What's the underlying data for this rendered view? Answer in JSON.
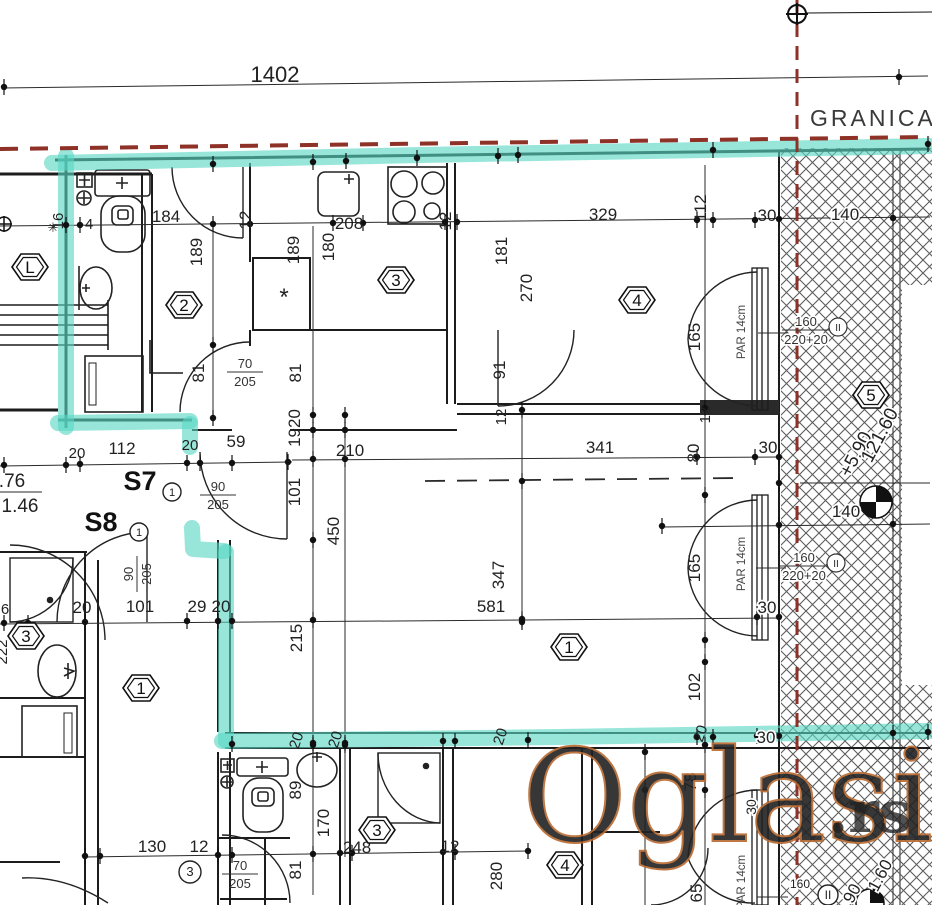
{
  "header": {
    "granica_label": "GRANICA",
    "top_dimension": "1402"
  },
  "stairs": {
    "s7": "S7",
    "s8": "S8"
  },
  "watermark": {
    "text": "Oglasi",
    "suffix": ".rs"
  },
  "colors": {
    "highlight": "#59d7c4",
    "boundary_red": "#8e3127",
    "wall": "#1c1c1c",
    "watermark_light": "#fcd9b0",
    "watermark_dark": "#d97f3e",
    "watermark_outline": "#b96a30",
    "watermark_suffix_gray": "#9b9b9b"
  },
  "par_window_label": "PAR 14cm",
  "dim_labels": [
    {
      "t": "16",
      "x": 63,
      "y": 221,
      "r": -90,
      "s": 15
    },
    {
      "t": "4",
      "x": 89,
      "y": 229,
      "s": 15
    },
    {
      "t": "184",
      "x": 166,
      "y": 222
    },
    {
      "t": "12",
      "x": 251,
      "y": 220,
      "r": -90
    },
    {
      "t": "208",
      "x": 349,
      "y": 229
    },
    {
      "t": "12",
      "x": 451,
      "y": 221,
      "r": -90
    },
    {
      "t": "329",
      "x": 603,
      "y": 220
    },
    {
      "t": "112",
      "x": 706,
      "y": 208,
      "r": -90
    },
    {
      "t": "30",
      "x": 767,
      "y": 221
    },
    {
      "t": "140",
      "x": 845,
      "y": 220,
      "h": 1
    },
    {
      "t": "189",
      "x": 202,
      "y": 252,
      "r": -90
    },
    {
      "t": "189",
      "x": 299,
      "y": 250,
      "r": -90
    },
    {
      "t": "180",
      "x": 334,
      "y": 247,
      "r": -90
    },
    {
      "t": "181",
      "x": 507,
      "y": 251,
      "r": -90
    },
    {
      "t": "270",
      "x": 532,
      "y": 288,
      "r": -90
    },
    {
      "t": "91",
      "x": 505,
      "y": 370,
      "r": -90
    },
    {
      "t": "81",
      "x": 204,
      "y": 373,
      "r": -90
    },
    {
      "t": "81",
      "x": 301,
      "y": 373,
      "r": -90
    },
    {
      "t": "*",
      "x": 284,
      "y": 305,
      "s": 24
    },
    {
      "t": "165",
      "x": 700,
      "y": 337,
      "r": -90
    },
    {
      "t": "12",
      "x": 710,
      "y": 415,
      "r": -90,
      "s": 15
    },
    {
      "t": "12",
      "x": 506,
      "y": 417,
      "r": -90,
      "s": 15
    },
    {
      "t": "1920",
      "x": 300,
      "y": 428,
      "r": -90
    },
    {
      "t": "210",
      "x": 350,
      "y": 456
    },
    {
      "t": "341",
      "x": 600,
      "y": 453
    },
    {
      "t": "80",
      "x": 699,
      "y": 453,
      "r": -90
    },
    {
      "t": "30",
      "x": 768,
      "y": 453
    },
    {
      "t": "20",
      "x": 77,
      "y": 458,
      "s": 15
    },
    {
      "t": "112",
      "x": 122,
      "y": 454
    },
    {
      "t": "20",
      "x": 190,
      "y": 450,
      "s": 15
    },
    {
      "t": "59",
      "x": 236,
      "y": 447
    },
    {
      "t": ".76",
      "x": 12,
      "y": 487,
      "s": 19
    },
    {
      "t": "1.46",
      "x": 20,
      "y": 512,
      "s": 19
    },
    {
      "t": "101",
      "x": 300,
      "y": 492,
      "r": -90
    },
    {
      "t": "450",
      "x": 339,
      "y": 531,
      "r": -90
    },
    {
      "t": "347",
      "x": 504,
      "y": 575,
      "r": -90
    },
    {
      "t": "581",
      "x": 491,
      "y": 612
    },
    {
      "t": "215",
      "x": 302,
      "y": 638,
      "r": -90
    },
    {
      "t": "165",
      "x": 700,
      "y": 568,
      "r": -90
    },
    {
      "t": "30",
      "x": 767,
      "y": 613,
      "h": 1
    },
    {
      "t": "140",
      "x": 846,
      "y": 517,
      "h": 1
    },
    {
      "t": "102",
      "x": 700,
      "y": 687,
      "r": -90
    },
    {
      "t": "6",
      "x": 5,
      "y": 614,
      "s": 15
    },
    {
      "t": "20",
      "x": 82,
      "y": 613
    },
    {
      "t": "101",
      "x": 140,
      "y": 612
    },
    {
      "t": "29",
      "x": 197,
      "y": 612
    },
    {
      "t": "20",
      "x": 221,
      "y": 612
    },
    {
      "t": "222",
      "x": 7,
      "y": 652,
      "r": -90,
      "s": 15
    },
    {
      "t": "+5.90",
      "x": 861,
      "y": 457,
      "r": -62,
      "s": 19,
      "h": 1
    },
    {
      "t": "121.60",
      "x": 885,
      "y": 438,
      "r": -62,
      "s": 19,
      "h": 1
    },
    {
      "t": "20",
      "x": 301,
      "y": 742,
      "r": -72,
      "s": 15
    },
    {
      "t": "20",
      "x": 340,
      "y": 741,
      "r": -72,
      "s": 15
    },
    {
      "t": "20",
      "x": 505,
      "y": 738,
      "r": -72,
      "s": 15
    },
    {
      "t": "20",
      "x": 705,
      "y": 735,
      "r": -72,
      "s": 15
    },
    {
      "t": "30",
      "x": 766,
      "y": 743,
      "h": 1
    },
    {
      "t": "89",
      "x": 301,
      "y": 790,
      "r": -90
    },
    {
      "t": "78",
      "x": 696,
      "y": 782,
      "r": -90
    },
    {
      "t": "170",
      "x": 329,
      "y": 823,
      "r": -90
    },
    {
      "t": "248",
      "x": 357,
      "y": 853
    },
    {
      "t": "130",
      "x": 152,
      "y": 852
    },
    {
      "t": "12",
      "x": 199,
      "y": 852
    },
    {
      "t": "12",
      "x": 450,
      "y": 852
    },
    {
      "t": "81",
      "x": 301,
      "y": 870,
      "r": -90
    },
    {
      "t": "280",
      "x": 502,
      "y": 876,
      "r": -90
    },
    {
      "t": "65",
      "x": 702,
      "y": 893,
      "r": -90
    },
    {
      "t": "30",
      "x": 756,
      "y": 807,
      "r": -90,
      "s": 14,
      "h": 1
    },
    {
      "t": "160",
      "x": 800,
      "y": 888,
      "s": 12,
      "h": 1
    },
    {
      "t": "90",
      "x": 857,
      "y": 896,
      "r": -62,
      "h": 1
    },
    {
      "t": "1.60",
      "x": 885,
      "y": 878,
      "r": -62,
      "h": 1
    }
  ],
  "room_labels": [
    {
      "n": "2",
      "x": 184,
      "y": 305
    },
    {
      "n": "3",
      "x": 396,
      "y": 280
    },
    {
      "n": "4",
      "x": 637,
      "y": 300
    },
    {
      "n": "5",
      "x": 871,
      "y": 395
    },
    {
      "n": "1",
      "x": 569,
      "y": 647
    },
    {
      "n": "L",
      "x": 30,
      "y": 267
    },
    {
      "n": "3",
      "x": 26,
      "y": 636
    },
    {
      "n": "1",
      "x": 141,
      "y": 688
    },
    {
      "n": "3",
      "x": 377,
      "y": 830
    },
    {
      "n": "4",
      "x": 565,
      "y": 865
    }
  ],
  "door_labels": [
    {
      "n": "1",
      "x": 172,
      "y": 492,
      "r": 9
    },
    {
      "n": "1",
      "x": 139,
      "y": 532,
      "r": 9
    },
    {
      "n": "3",
      "x": 190,
      "y": 872,
      "r": 11
    },
    {
      "n": "II",
      "x": 828,
      "y": 895,
      "r": 10
    }
  ],
  "door_size_fractions": [
    {
      "a": "70",
      "b": "205",
      "x": 245,
      "y": 372,
      "v": false
    },
    {
      "a": "90",
      "b": "205",
      "x": 218,
      "y": 495,
      "v": false
    },
    {
      "a": "90",
      "b": "205",
      "x": 137,
      "y": 574,
      "v": true
    },
    {
      "a": "70",
      "b": "205",
      "x": 240,
      "y": 874,
      "v": false
    }
  ],
  "window_specs": [
    {
      "w": "160",
      "h": "220+20",
      "m": "II",
      "x": 806,
      "y": 330
    },
    {
      "w": "160",
      "h": "220+20",
      "m": "II",
      "x": 804,
      "y": 566
    }
  ],
  "par_labels": [
    {
      "x": 745,
      "y": 332
    },
    {
      "x": 745,
      "y": 564
    },
    {
      "x": 745,
      "y": 882
    }
  ]
}
